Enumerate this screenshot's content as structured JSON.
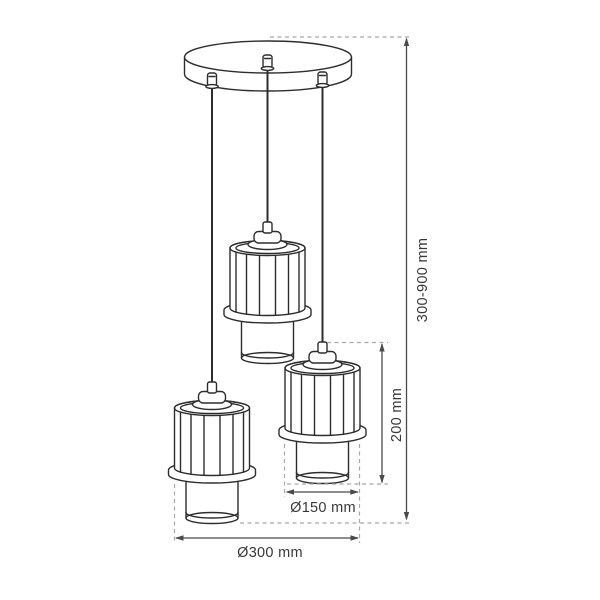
{
  "diagram": {
    "labels": {
      "drop_height": "300-900 mm",
      "shade_height": "200 mm",
      "shade_diameter": "Ø150 mm",
      "fixture_diameter": "Ø300 mm"
    },
    "colors": {
      "artwork_line": "#2d2d2d",
      "dimension_line": "#4a4a4a",
      "extension_line": "#a8a8a8",
      "label_text": "#383838",
      "background": "#ffffff"
    }
  }
}
